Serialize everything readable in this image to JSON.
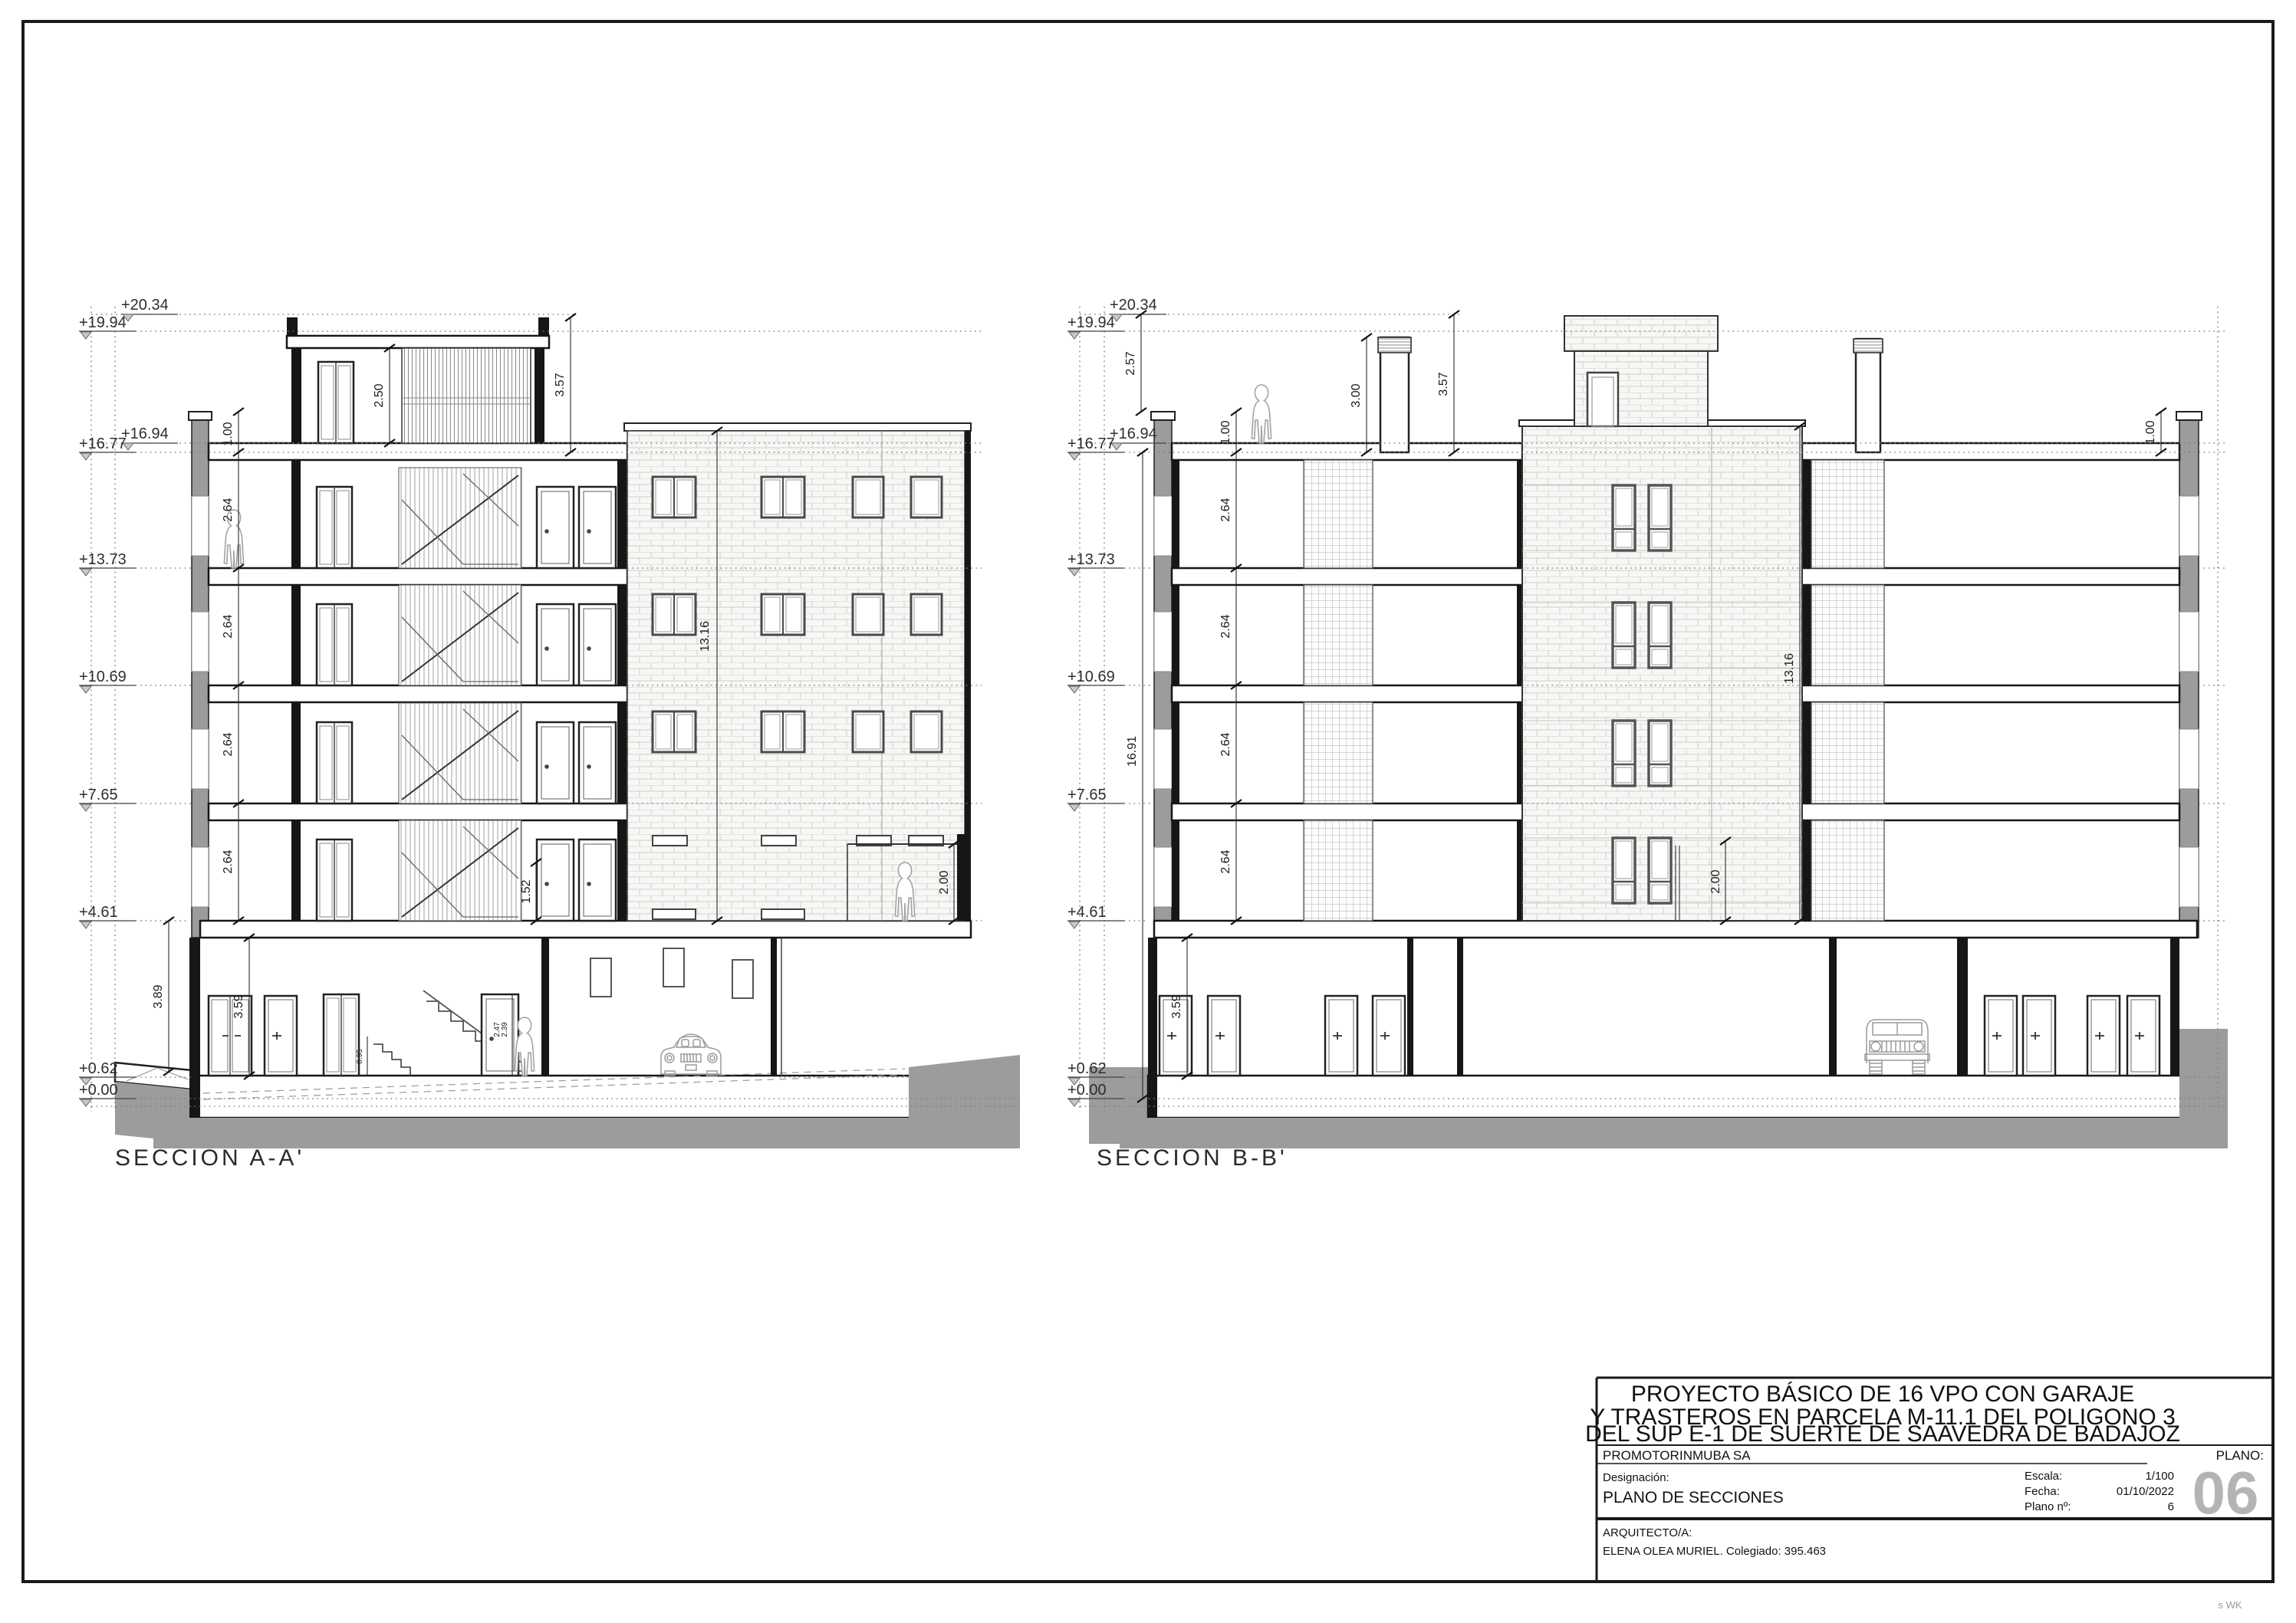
{
  "sheet": {
    "watermark": "s WK",
    "colors": {
      "ground": "#9c9c9c",
      "cut_wall": "#161616",
      "line": "#1a1a1a",
      "sheet_number_gray": "#b4b4b4",
      "brick_line": "#cfcfcc"
    }
  },
  "section_a": {
    "title": "SECCION A-A'",
    "levels": [
      "+20.34",
      "+19.94",
      "+16.94",
      "+16.77",
      "+13.73",
      "+10.69",
      "+7.65",
      "+4.61",
      "+0.62",
      "+0.00"
    ],
    "dim_parapet": "1.00",
    "dim_floor": "2.64",
    "dim_bulkhead": "2.50",
    "dim_bulkhead_total": "3.57",
    "dim_facade": "13.16",
    "dim_door": "1.52",
    "dim_fence": "2.00",
    "dim_basement": "3.89",
    "dim_basement_clear": "3.59",
    "dim_stair_1": "0.95",
    "dim_stair_2": "2.47",
    "dim_stair_3": "2.39"
  },
  "section_b": {
    "title": "SECCION B-B'",
    "levels": [
      "+20.34",
      "+19.94",
      "+16.94",
      "+16.77",
      "+13.73",
      "+10.69",
      "+7.65",
      "+4.61",
      "+0.62",
      "+0.00"
    ],
    "dim_roof_parapet": "2.57",
    "dim_parapet_left": "1.00",
    "dim_floor": "2.64",
    "dim_chimney": "3.00",
    "dim_chimney_total": "3.57",
    "dim_total_height": "16.91",
    "dim_facade": "13.16",
    "dim_window": "2.00",
    "dim_basement_clear": "3.59",
    "dim_parapet_right": "1.00"
  },
  "title_block": {
    "project_title_1": "PROYECTO BÁSICO DE 16 VPO CON GARAJE",
    "project_title_2": "Y TRASTEROS EN PARCELA M-11.1 DEL POLIGONO 3",
    "project_title_3": "DEL SUP E-1 DE SUERTE DE SAAVEDRA DE BADAJOZ",
    "promotor_label": "PROMOTOR:",
    "promotor_value": "INMUBA SA",
    "plano_label": "PLANO:",
    "designacion_label": "Designación:",
    "designacion_value": "PLANO DE SECCIONES",
    "escala_label": "Escala:",
    "escala_value": "1/100",
    "fecha_label": "Fecha:",
    "fecha_value": "01/10/2022",
    "plano_num_label": "Plano nº:",
    "plano_num_value": "6",
    "sheet_number": "06",
    "arquitecto_label": "ARQUITECTO/A:",
    "arquitecto_value": "ELENA OLEA MURIEL. Colegiado: 395.463"
  }
}
